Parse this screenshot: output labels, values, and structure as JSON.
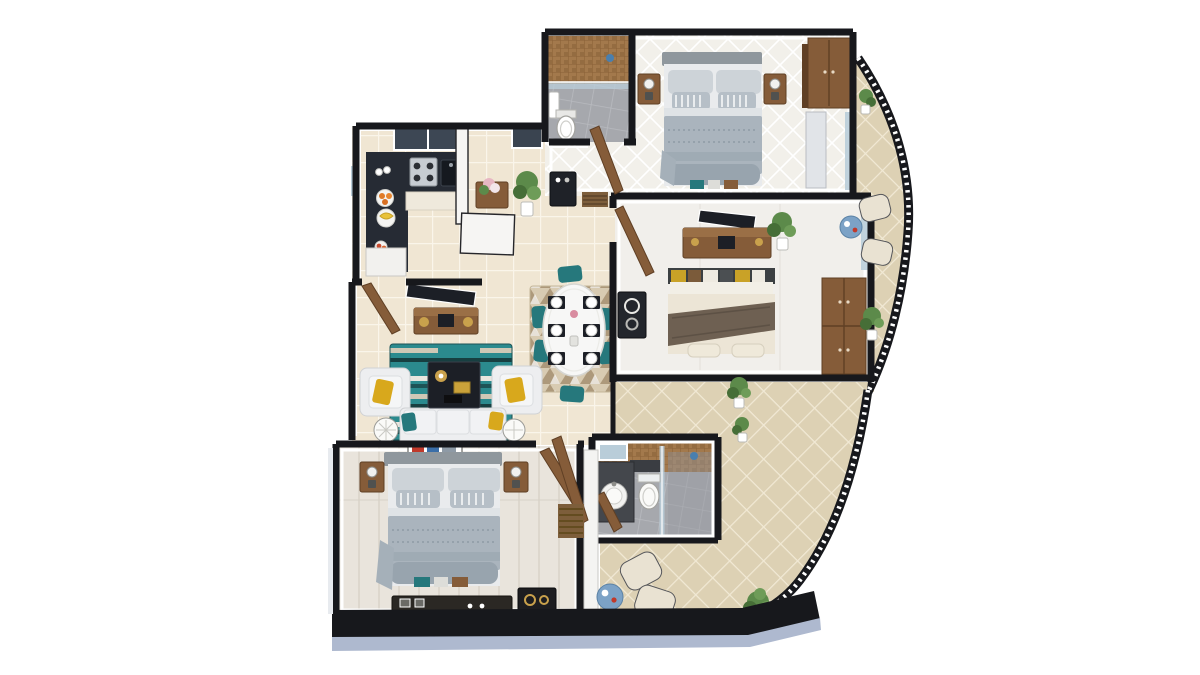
{
  "meta": {
    "title": "3D apartment floor plan render, top-down view",
    "view": "top-down 3d render",
    "visible_text": "none"
  },
  "palette": {
    "background": "#ffffff",
    "wall": "#17181c",
    "wallFace": "#f6f5f3",
    "wallSide": "#aeb9cf",
    "floorCream": "#f0e6d3",
    "floorCreamLine": "#faf5ea",
    "floorWhite": "#f2f0ea",
    "floorWood": "#e9e4dc",
    "floorWoodLine": "#d8d2c7",
    "terraceTile": "#ddd1b4",
    "terraceTileLine": "#f1e9d5",
    "bathTile": "#a6a8ad",
    "bathTileLine": "#b8babf",
    "mosaic": "#a3794c",
    "mosaicLine": "#8a6137",
    "wood": "#855c39",
    "woodDark": "#5f3f24",
    "woodLight": "#9a6f46",
    "counter": "#262b34",
    "steel": "#c7ccd2",
    "bedGray": "#aab4bd",
    "bedGrayLight": "#cdd3d8",
    "bedSheet": "#e9ebed",
    "headboard": "#8f979d",
    "bedCream": "#ece5d6",
    "throw": "#6e6052",
    "sofa": "#edeef0",
    "teal": "#26787c",
    "yellow": "#d8a81c",
    "rugTealBase": "#2b8a8e",
    "rugBeige": "#d8cbb2",
    "rugBrown": "#8a6f4e",
    "tableWhite": "#f7f7f6",
    "plant": "#5c8a4a",
    "plantDark": "#466e37",
    "blueTable": "#7ca2c6",
    "glass": "#b9cdd9",
    "dark": "#1c1f26",
    "gold": "#c9a14c"
  },
  "rooms": [
    {
      "id": "master-bedroom",
      "label": "Master Bedroom (top right)",
      "furniture": [
        "double bed with gray bedding",
        "two wood nightstands with lamps",
        "wardrobe",
        "glass balcony door",
        "storage bench boxes"
      ]
    },
    {
      "id": "ensuite-bathroom",
      "label": "Ensuite Bathroom (top left of master)",
      "furniture": [
        "brown mosaic shower wall",
        "glass shower partition",
        "toilet",
        "wall basin"
      ]
    },
    {
      "id": "bedroom-2",
      "label": "Bedroom 2 (middle right)",
      "furniture": [
        "wall TV",
        "wood TV console",
        "double bed with cream bedding and brown throw",
        "wardrobe",
        "dark dresser",
        "potted plant",
        "glass balcony door"
      ]
    },
    {
      "id": "kitchen",
      "label": "Kitchen (left)",
      "furniture": [
        "L-shaped dark counter",
        "gas stove",
        "sink",
        "fruit plates",
        "window"
      ]
    },
    {
      "id": "foyer",
      "label": "Foyer nook (center top)",
      "furniture": [
        "console table with flowers",
        "potted plant",
        "window"
      ]
    },
    {
      "id": "hallway",
      "label": "Hallway (center)",
      "furniture": [
        "dark console table",
        "striped doormat",
        "wood doors"
      ]
    },
    {
      "id": "dining",
      "label": "Dining Area (center)",
      "furniture": [
        "oval white table",
        "six teal chairs",
        "six place settings",
        "patterned rug"
      ]
    },
    {
      "id": "living-room",
      "label": "Living Room (center left)",
      "furniture": [
        "wall TV",
        "wood TV console with speakers",
        "two white armchairs with yellow pillows",
        "three-seat white sofa",
        "dark coffee table with gold tray",
        "teal patterned rug",
        "two round side tables",
        "entry door"
      ]
    },
    {
      "id": "bedroom-3",
      "label": "Bedroom 3 (bottom left)",
      "furniture": [
        "double bed with gray bedding",
        "two nightstands with lamps",
        "wall art",
        "long dark desk",
        "dark cabinet with gold rings",
        "storage boxes"
      ]
    },
    {
      "id": "bathroom-2",
      "label": "Common Bathroom (bottom center)",
      "furniture": [
        "round basin on dark vanity",
        "mirror",
        "toilet",
        "mosaic wall",
        "glass shower partition",
        "wood door"
      ]
    },
    {
      "id": "balcony",
      "label": "Balcony (right, curved)",
      "furniture": [
        "curved black railing",
        "two cream chairs",
        "round blue table",
        "potted plants",
        "diamond tiles"
      ]
    },
    {
      "id": "terrace",
      "label": "Terrace (bottom right)",
      "furniture": [
        "curved black railing",
        "two cream chairs",
        "round blue table",
        "plants",
        "wood slat mat",
        "diamond tiles"
      ]
    }
  ]
}
